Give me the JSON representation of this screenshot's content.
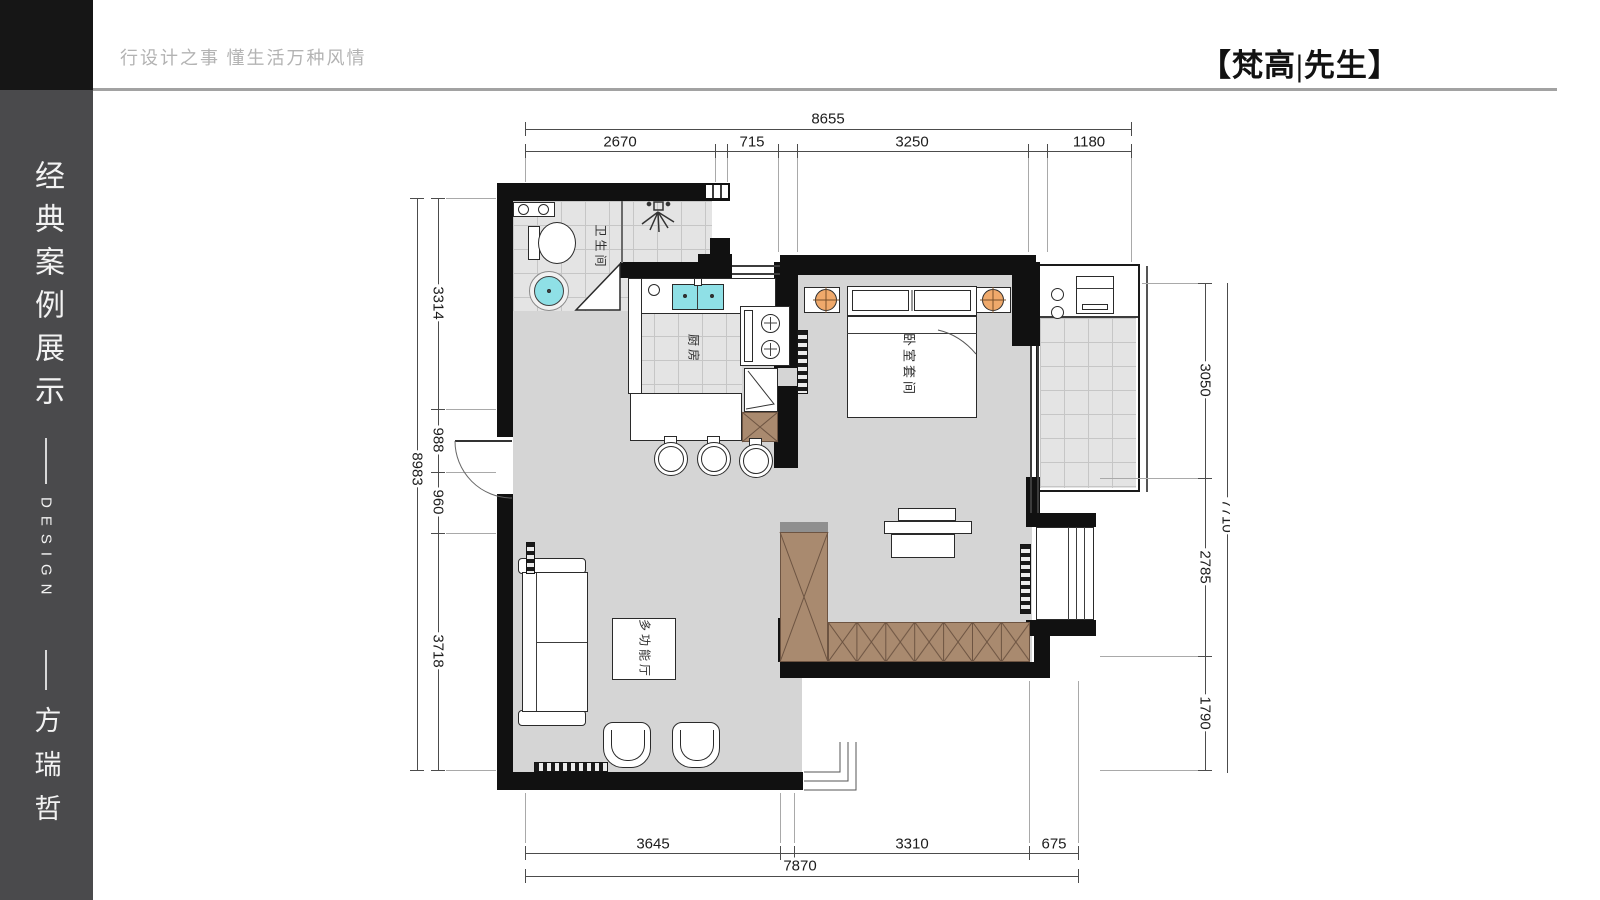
{
  "header": {
    "slogan": "行设计之事 懂生活万种风情",
    "brand": "【梵高|先生】"
  },
  "sidebar": {
    "title": "经典案例展示",
    "design": "DESIGN",
    "author": "方瑞哲"
  },
  "plan": {
    "rooms": {
      "bathroom": "卫生间",
      "kitchen": "厨房",
      "bedroom": "卧室套间",
      "hall": "多功能厅"
    },
    "dims": {
      "top": {
        "overall": "8655",
        "seg": [
          "2670",
          "715",
          "3250",
          "1180"
        ]
      },
      "left": {
        "overall": "8983",
        "seg": [
          "3314",
          "988",
          "960",
          "3718"
        ]
      },
      "right": {
        "overall": "7710",
        "seg": [
          "3050",
          "2785",
          "1790"
        ]
      },
      "bottom": {
        "overall": "7870",
        "seg": [
          "3645",
          "3310",
          "675"
        ]
      }
    },
    "colors": {
      "wall": "#111111",
      "floor": "#d5d5d5",
      "tile": "#e4e4e4",
      "wardrobe": "#a98a6f",
      "fixture_cyan": "#8fe0e6",
      "lamp_orange": "#efa96b"
    }
  }
}
